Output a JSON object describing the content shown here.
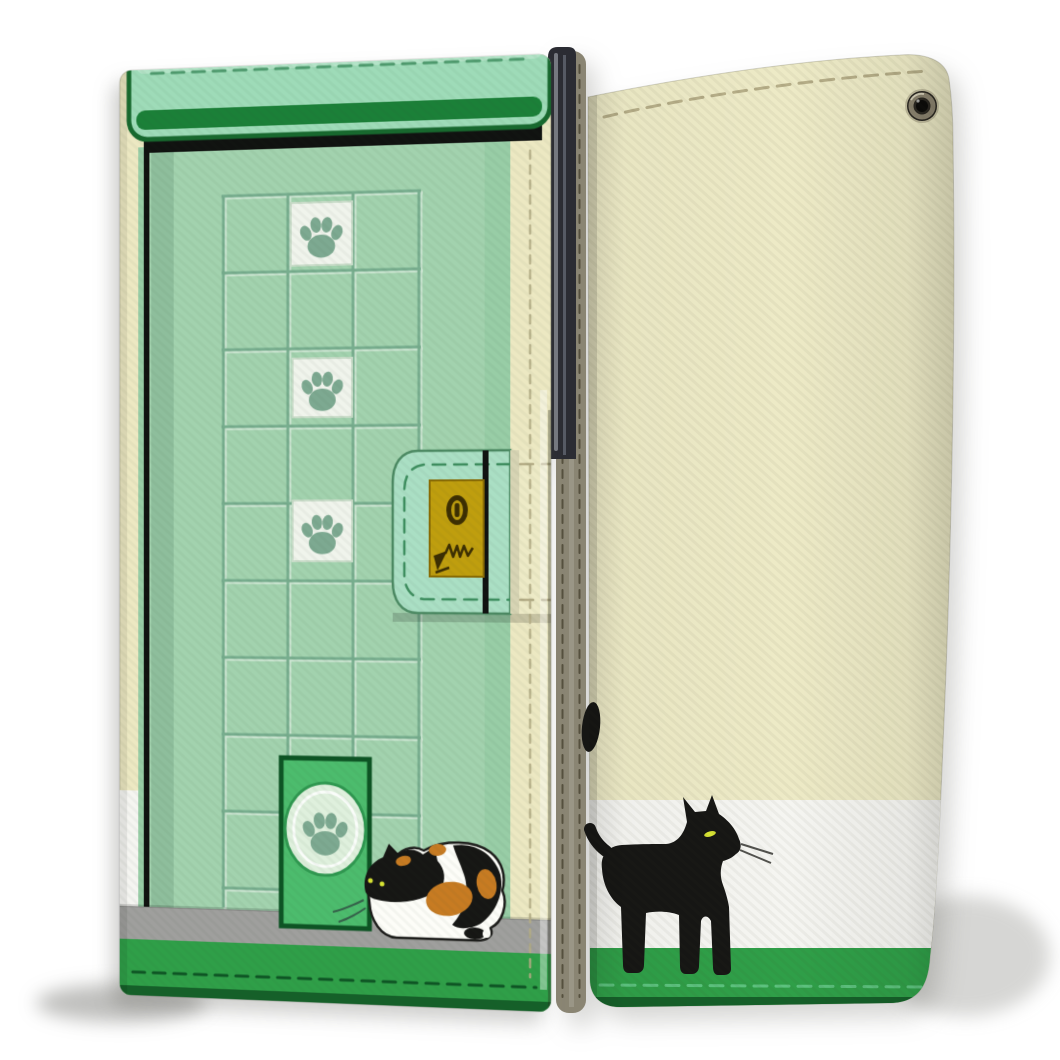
{
  "scene": {
    "type": "product-photo",
    "subject": "Cat-themed flip wallet smartphone case shown from front and back",
    "background_color": "#ffffff",
    "views": [
      "front cover with green cat-door artwork",
      "back cover with black cat artwork"
    ]
  },
  "colors": {
    "mint": "#9edbb8",
    "flap_mint": "#aadfc4",
    "awning_lip": "#1b8038",
    "dark_green": "#17692e",
    "door_face": "#a2d2ae",
    "door_sage": "#98cda6",
    "grid_line": "#77ad8e",
    "grid_line_light": "#d9ecdd",
    "frame_black": "#101210",
    "bright_green": "#4cbc6d",
    "deep_green": "#0d5424",
    "oval_fill": "#dff0dd",
    "oval_ring": "#2f9850",
    "strip_green": "#2f9f48",
    "strip_green_dark": "#156029",
    "cream": "#ece8c2",
    "cream_back": "#edeac6",
    "white_band": "#f5f5f1",
    "floor_gray": "#9f9f9d",
    "khaki": "#8a8573",
    "phone_dark": "#2b2c33",
    "lock_gold": "#bf9e0e",
    "lock_edge": "#8a6c04",
    "lock_mark": "#3c2e02",
    "tile_white": "#f0f4ec",
    "tile_edge": "#c9dcc9",
    "paw_gray": "#7da991",
    "stitch_mint": "#3f8f60",
    "stitch_cream": "#b3ab85",
    "stitch_khaki": "#55503e",
    "stitch_green_light": "#5cc27e",
    "stitch_green_dark": "#0e5524",
    "flap_edge": "#4c8a63",
    "cat_black": "#161614",
    "cat_white": "#fdfdf8",
    "cat_orange": "#c77b22",
    "eye_yellow": "#d8e433",
    "whisker_dark": "#52524e",
    "whisker_green": "#35604a",
    "grommet_dark": "#2b2822",
    "grommet_ring": "#8c8470"
  },
  "front_case": {
    "artwork": "green house door with tiled window grid",
    "paw_tiles": 3,
    "elements": [
      "awning",
      "door-grid",
      "paw-print-tiles",
      "cat-flap-door",
      "calico-cat",
      "floor-strip",
      "grass-strip",
      "clasp-strap",
      "gold-lock-plate"
    ]
  },
  "back_case": {
    "artwork": "black cat walking along white and green stripes",
    "elements": [
      "spine-strap",
      "phone-edge",
      "eyelet",
      "white-stripe",
      "green-stripe",
      "black-cat"
    ]
  },
  "icons": {
    "paw_print": "paw-print-icon",
    "keyhole": "keyhole-icon",
    "claw_scratch": "claw-scratch-icon",
    "eyelet": "eyelet-icon"
  }
}
